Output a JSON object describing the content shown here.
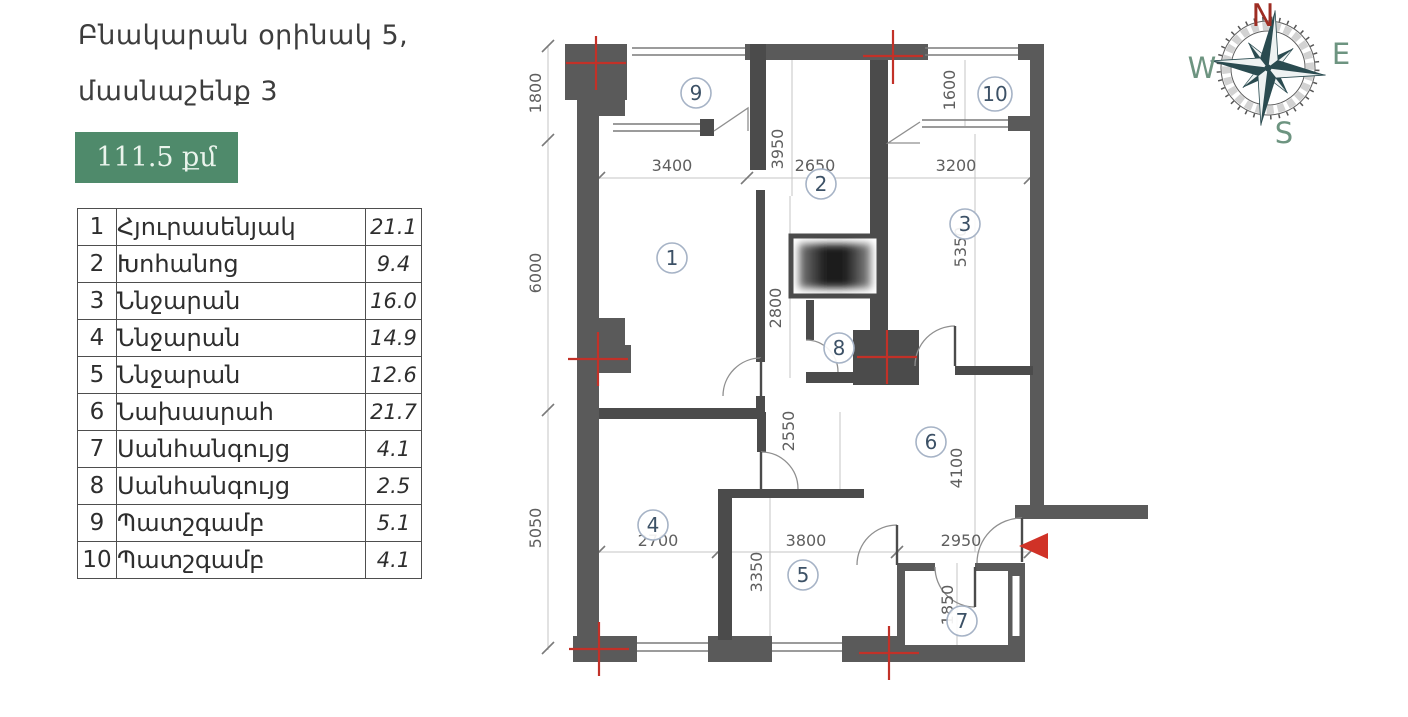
{
  "header": {
    "title_line1": "Բնակարան օրինակ 5,",
    "title_line2": "մասնաշենք 3"
  },
  "area_badge": {
    "label": "111.5 քմ"
  },
  "rooms_table": {
    "rows": [
      {
        "num": "1",
        "name": "Հյուրասենյակ",
        "area": "21.1"
      },
      {
        "num": "2",
        "name": "Խոհանոց",
        "area": "9.4"
      },
      {
        "num": "3",
        "name": "Ննջարան",
        "area": "16.0"
      },
      {
        "num": "4",
        "name": "Ննջարան",
        "area": "14.9"
      },
      {
        "num": "5",
        "name": "Ննջարան",
        "area": "12.6"
      },
      {
        "num": "6",
        "name": "Նախասրահ",
        "area": "21.7"
      },
      {
        "num": "7",
        "name": "Սանհանգույց",
        "area": "4.1"
      },
      {
        "num": "8",
        "name": "Սանհանգույց",
        "area": "2.5"
      },
      {
        "num": "9",
        "name": "Պատշգամբ",
        "area": "5.1"
      },
      {
        "num": "10",
        "name": "Պատշգամբ",
        "area": "4.1"
      }
    ]
  },
  "floor_plan": {
    "room_markers": [
      "1",
      "2",
      "3",
      "4",
      "5",
      "6",
      "7",
      "8",
      "9",
      "10"
    ],
    "dims": {
      "d1800": "1800",
      "d6000": "6000",
      "d5050": "5050",
      "d3400": "3400",
      "d2650": "2650",
      "d3200": "3200",
      "d3950": "3950",
      "d1600": "1600",
      "d5350": "5350",
      "d2800": "2800",
      "d2550": "2550",
      "d4100": "4100",
      "d3350": "3350",
      "d2700": "2700",
      "d3800": "3800",
      "d2950": "2950",
      "d1850": "1850"
    }
  },
  "compass": {
    "north": "N",
    "east": "E",
    "south": "S",
    "west": "W"
  },
  "colors": {
    "badge_green": "#4f8a6b",
    "entrance_red": "#d03227",
    "axis_red": "#c23128",
    "compass_dark": "#2a4b50",
    "compass_letter_green": "#6d9480",
    "compass_north_red": "#9e2d23"
  }
}
